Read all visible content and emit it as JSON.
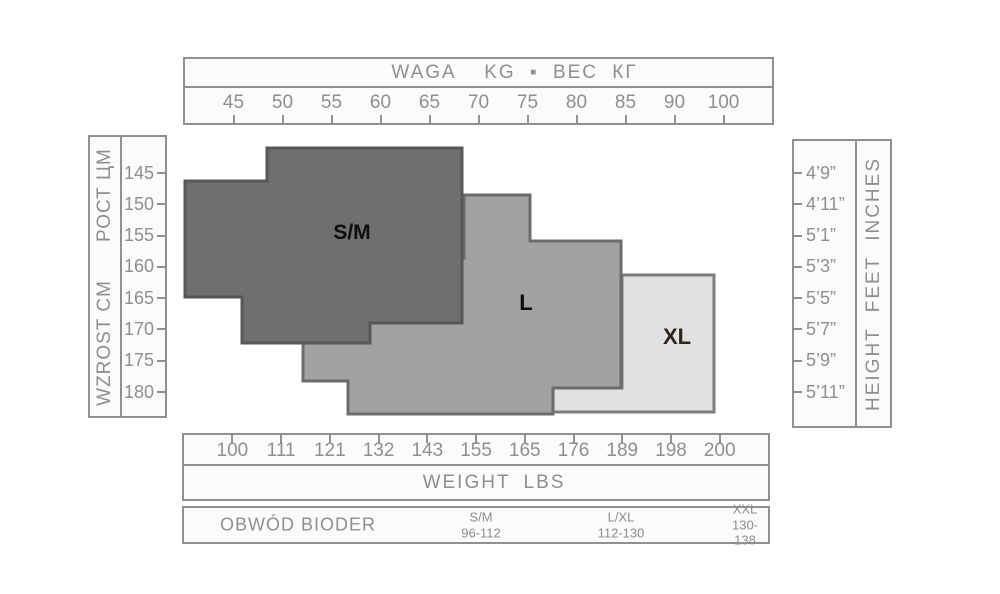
{
  "top_axis": {
    "title": "WAGA  KG ▪ ВЕС КГ",
    "ticks": [
      "45",
      "50",
      "55",
      "60",
      "65",
      "70",
      "75",
      "80",
      "85",
      "90",
      "100"
    ]
  },
  "bottom_axis": {
    "ticks": [
      "100",
      "111",
      "121",
      "132",
      "143",
      "155",
      "165",
      "176",
      "189",
      "198",
      "200"
    ],
    "title": "WEIGHT  LBS"
  },
  "left_axis": {
    "label_pl": "WZROST CM",
    "label_ru": "РОСТ ЦМ",
    "ticks": [
      "145",
      "150",
      "155",
      "160",
      "165",
      "170",
      "175",
      "180"
    ]
  },
  "right_axis": {
    "label": "HEIGHT FEET INCHES",
    "ticks": [
      "4’9”",
      "4’11”",
      "5’1”",
      "5’3”",
      "5’5”",
      "5’7”",
      "5’9”",
      "5’11”"
    ]
  },
  "regions": [
    {
      "id": "sm",
      "label": "S/M",
      "points": "267,148 462,148 462,323 370,323 370,343 242,343 242,297 185,297 185,181 267,181"
    },
    {
      "id": "l",
      "label": "L",
      "points": "464,195 530,195 530,241 621,241 621,388 553,388 553,414 348,414 348,381 303,381 303,345 303,258 464,258"
    },
    {
      "id": "xl",
      "label": "XL",
      "points": "622,275 714,275 714,412 553,412 553,388 622,388"
    }
  ],
  "hip_table": {
    "label": "OBWÓD BIODER",
    "entries": [
      {
        "size": "S/M",
        "range": "96-112"
      },
      {
        "size": "L/XL",
        "range": "112-130"
      },
      {
        "size": "XXL",
        "range": "130-138"
      }
    ]
  },
  "colors": {
    "sm_fill": "#6f6f71",
    "sm_border": "#57575a",
    "l_fill": "#a2a2a4",
    "l_border": "#6b6c6e",
    "xl_fill": "#e1e1e3",
    "xl_border": "#7c7d7f",
    "box_border": "#8e9092",
    "axis_text": "#8e8f91",
    "sm_label": "#0e0e0e",
    "l_label": "#0c0c0c",
    "xl_label": "#2e2718"
  },
  "chart_data": {
    "type": "area",
    "title": "Hosiery size chart: weight vs height with stepped size regions",
    "x_axis_top": {
      "label": "WAGA  KG ▪ ВЕС КГ",
      "ticks": [
        45,
        50,
        55,
        60,
        65,
        70,
        75,
        80,
        85,
        90,
        100
      ]
    },
    "x_axis_bottom": {
      "label": "WEIGHT  LBS",
      "ticks": [
        100,
        111,
        121,
        132,
        143,
        155,
        165,
        176,
        189,
        198,
        200
      ]
    },
    "y_axis_left": {
      "label": "WZROST CM / РОСТ ЦМ",
      "ticks": [
        145,
        150,
        155,
        160,
        165,
        170,
        175,
        180
      ]
    },
    "y_axis_right": {
      "label": "HEIGHT FEET INCHES",
      "ticks": [
        "4’9”",
        "4’11”",
        "5’1”",
        "5’3”",
        "5’5”",
        "5’7”",
        "5’9”",
        "5’11”"
      ]
    },
    "regions": [
      {
        "label": "S/M",
        "weight_kg_range": [
          40,
          68
        ],
        "height_cm_range": [
          141,
          172
        ]
      },
      {
        "label": "L",
        "weight_kg_range": [
          52,
          85
        ],
        "height_cm_range": [
          148,
          184
        ]
      },
      {
        "label": "XL",
        "weight_kg_range": [
          85,
          94
        ],
        "height_cm_range": [
          161,
          183
        ]
      }
    ],
    "hip_circumference_cm": {
      "S/M": "96-112",
      "L/XL": "112-130",
      "XXL": "130-138"
    },
    "legend_position": "none",
    "grid": false
  }
}
